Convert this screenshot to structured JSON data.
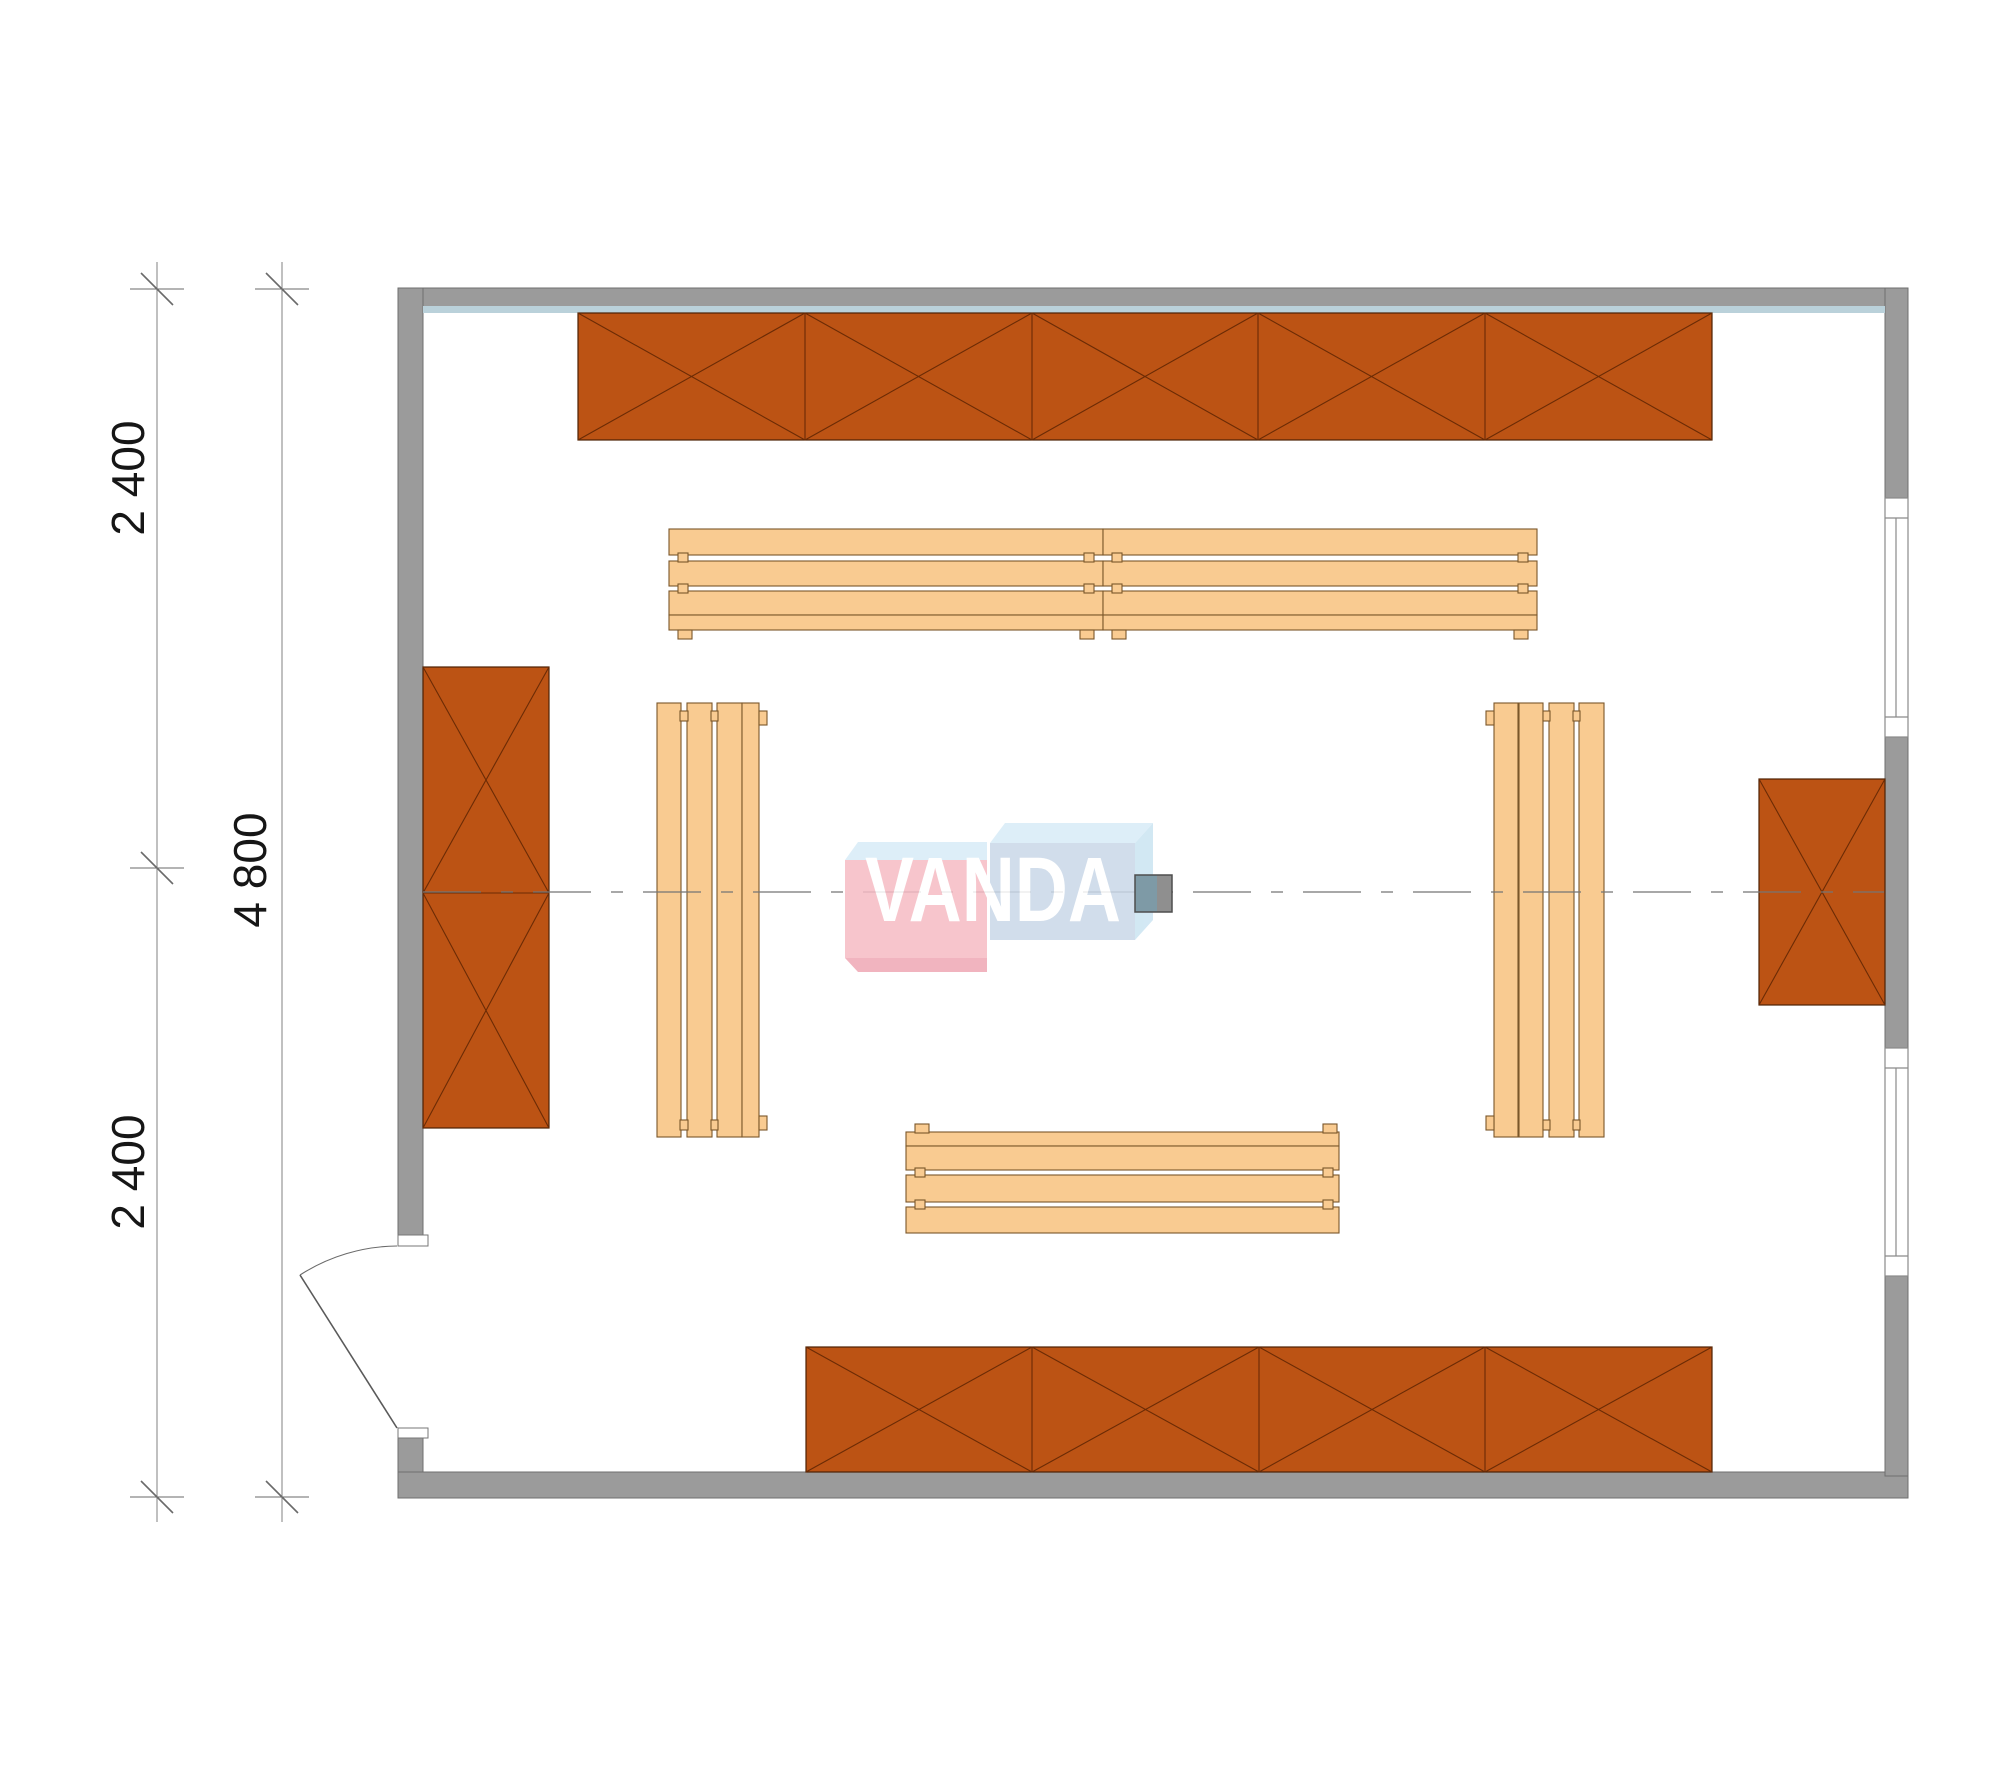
{
  "plan": {
    "title": "sauna-floor-plan",
    "watermark": {
      "text": "VANDA"
    },
    "dimension_labels": {
      "upper_left": "2 400",
      "lower_left": "2 400",
      "total_left": "4 800"
    },
    "colors": {
      "wall": "#9B9B9B",
      "wall_liner": "#BAD1DA",
      "cabinet": "#BC5314",
      "cabinet_line": "#6B2B05",
      "bench_wood": "#F9CB91",
      "bench_line": "#7A572A",
      "heater_body": "#7E9AA6",
      "heater_side": "#8F8F8F",
      "watermark_pink": "#F6BCC4",
      "watermark_pink_shadow": "#EFA8B4",
      "watermark_blue": "#C9D8E8",
      "watermark_blue_side": "#CBE4F2",
      "watermark_sky": "#D8ECF7"
    },
    "elements": {
      "top_wall_shelf_sections": 5,
      "bottom_wall_shelf_sections": 4,
      "left_cabinet_sections": 2,
      "right_cabinet_sections": 1,
      "benches": 5,
      "windows": 2,
      "doors": 1,
      "heaters": 1
    }
  }
}
